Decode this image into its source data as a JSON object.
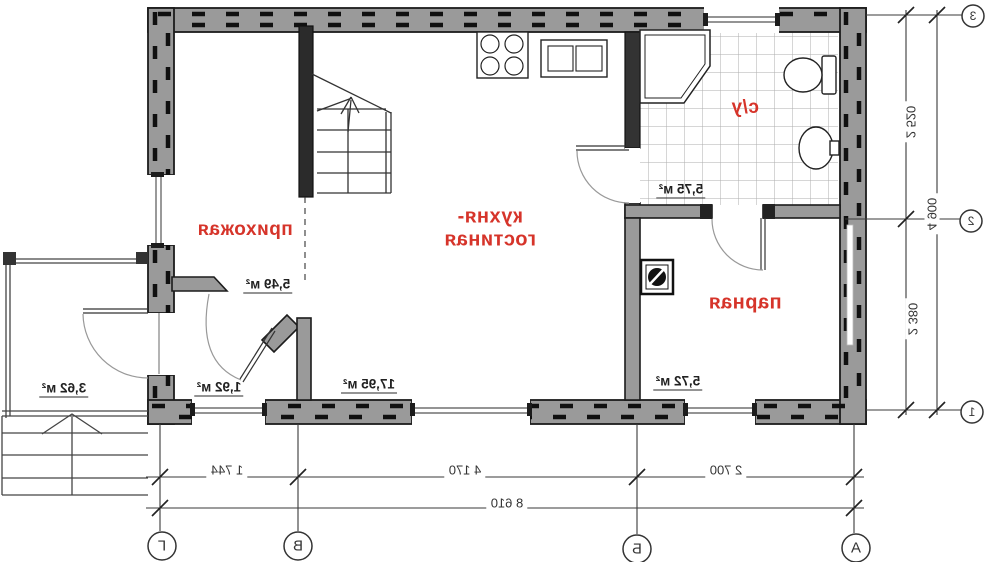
{
  "floor_plan": {
    "rooms": {
      "hallway": {
        "label": "прихожая",
        "area": "5,49 м²"
      },
      "kitchen_living": {
        "label_line1": "кухня-",
        "label_line2": "гостиная",
        "area": "17,95 м²"
      },
      "bathroom": {
        "label": "с/у",
        "area": "5,75 м²"
      },
      "steam_room": {
        "label": "парная",
        "area": "5,72 м²"
      },
      "vestibule": {
        "area": "1,92 м²"
      },
      "porch": {
        "area": "3,62 м²"
      }
    },
    "dimensions": {
      "bottom_segments": [
        "1 744",
        "4 170",
        "2 700"
      ],
      "bottom_total": "8 610",
      "right_segments": [
        "2 520",
        "2 380"
      ],
      "right_total": "4 900"
    },
    "axes": {
      "bottom": [
        "Г",
        "В",
        "Б",
        "А"
      ],
      "right": [
        "3",
        "2",
        "1"
      ]
    },
    "colors": {
      "room_label_red": "#d6342a",
      "wall_fill_gray": "#9a9a9a",
      "wall_edge_black": "#1c1c1c"
    }
  }
}
